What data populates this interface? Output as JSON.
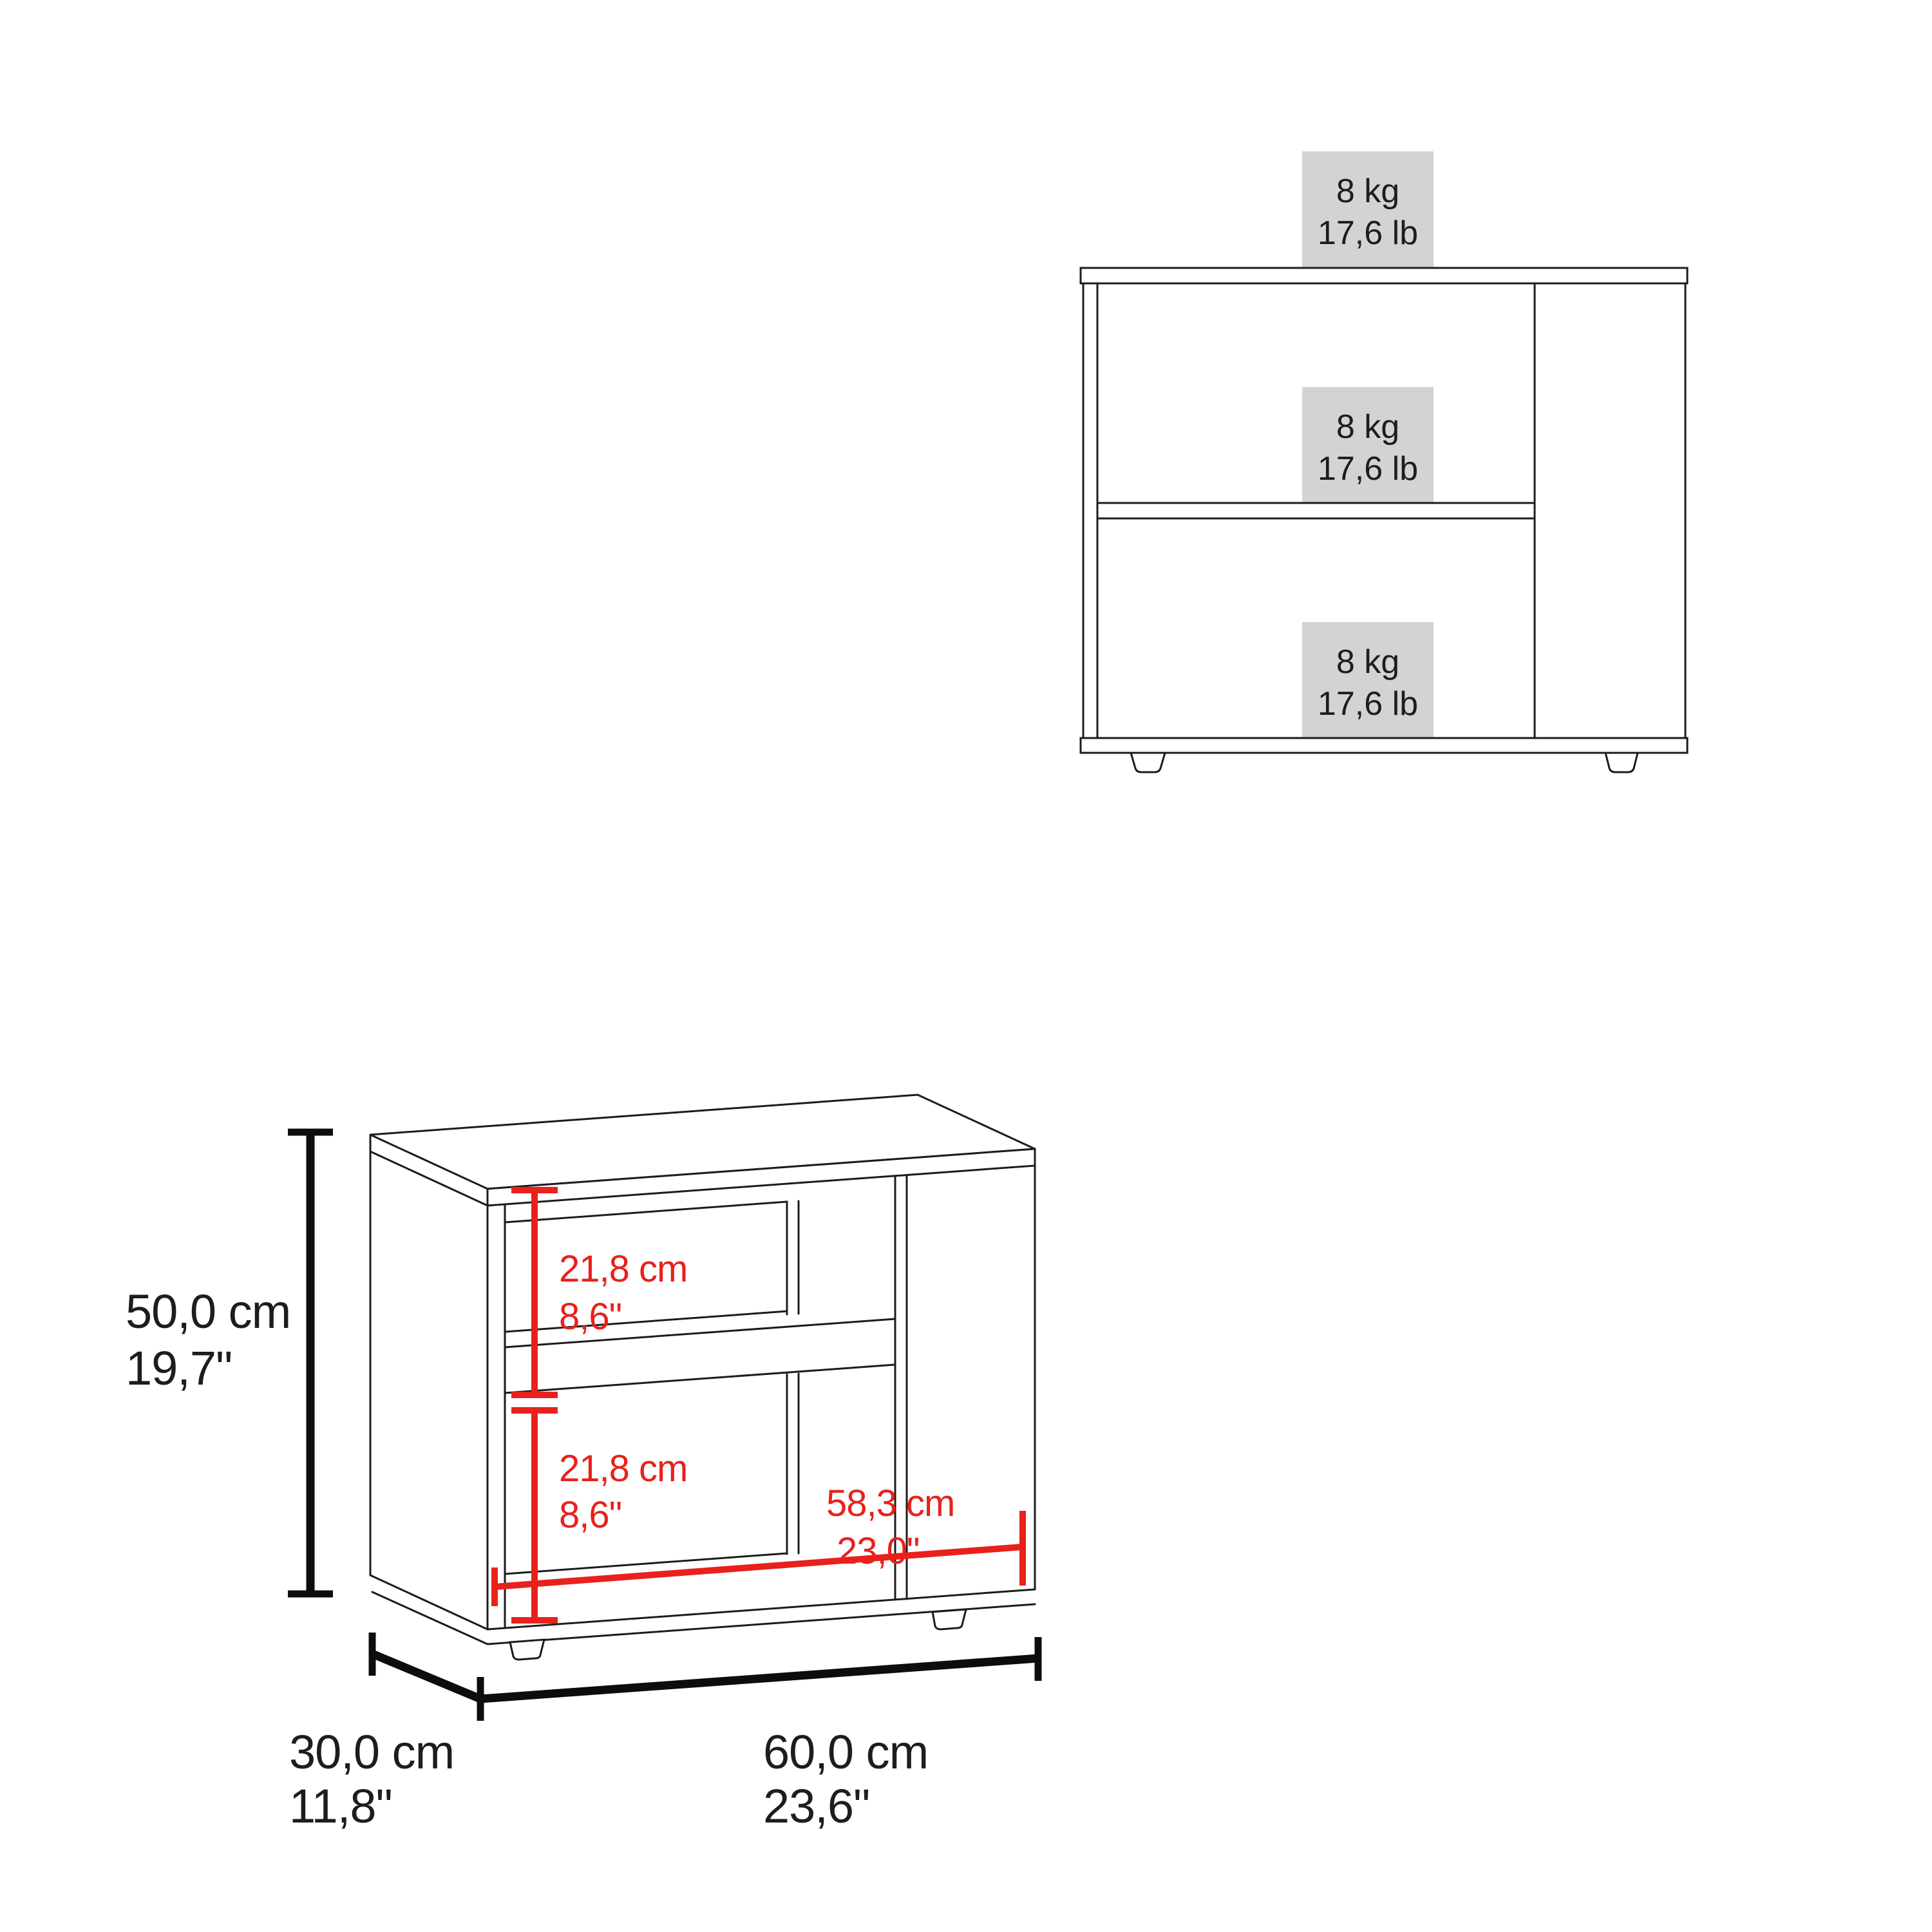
{
  "drawing": {
    "type": "furniture-dimension-diagram",
    "views": [
      "front-load-capacity-view",
      "perspective-dimension-view"
    ]
  },
  "colors": {
    "background": "#ffffff",
    "line_black": "#1c1c1c",
    "dimension_red": "#e8211c",
    "label_black": "#1d1d1b",
    "load_box_gray": "#d3d3d3"
  },
  "front_view": {
    "load_labels": [
      {
        "kg": "8 kg",
        "lb": "17,6 lb",
        "position": "top-surface"
      },
      {
        "kg": "8 kg",
        "lb": "17,6 lb",
        "position": "middle-shelf"
      },
      {
        "kg": "8 kg",
        "lb": "17,6 lb",
        "position": "bottom-shelf"
      }
    ]
  },
  "perspective_view": {
    "height": {
      "cm": "50,0 cm",
      "in": "19,7\""
    },
    "depth": {
      "cm": "30,0 cm",
      "in": "11,8\""
    },
    "width": {
      "cm": "60,0 cm",
      "in": "23,6\""
    },
    "interior_width": {
      "cm": "58,3 cm",
      "in": "23,0\""
    },
    "upper_compartment_height": {
      "cm": "21,8 cm",
      "in": "8,6\""
    },
    "lower_compartment_height": {
      "cm": "21,8 cm",
      "in": "8,6\""
    }
  }
}
